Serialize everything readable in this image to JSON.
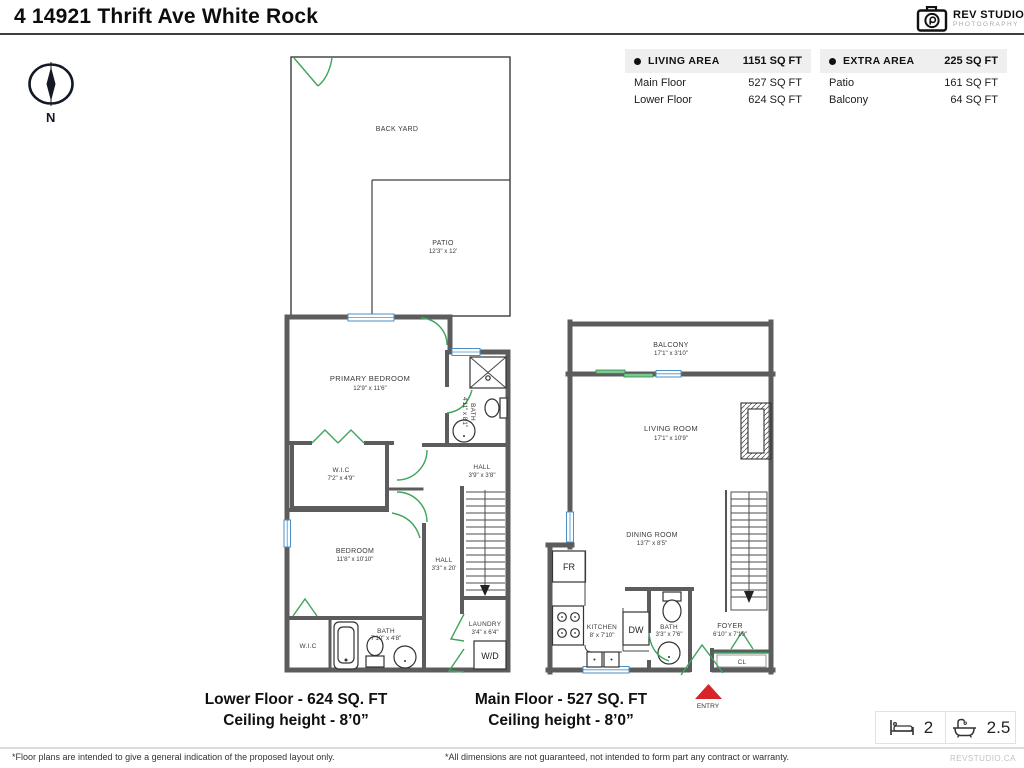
{
  "title": "4 14921 Thrift Ave White Rock",
  "logo": {
    "name": "REV STUDIO",
    "subtitle": "PHOTOGRAPHY"
  },
  "compass": {
    "north_label": "N"
  },
  "tables": {
    "living": {
      "title": "LIVING AREA",
      "total": "1151 SQ FT",
      "rows": [
        {
          "label": "Main Floor",
          "value": "527 SQ FT"
        },
        {
          "label": "Lower Floor",
          "value": "624 SQ FT"
        }
      ]
    },
    "extra": {
      "title": "EXTRA AREA",
      "total": "225 SQ FT",
      "rows": [
        {
          "label": "Patio",
          "value": "161 SQ FT"
        },
        {
          "label": "Balcony",
          "value": "64 SQ FT"
        }
      ]
    }
  },
  "lower": {
    "caption1": "Lower Floor - 624 SQ. FT",
    "caption2": "Ceiling height - 8’0”",
    "rooms": {
      "back_yard": {
        "name": "BACK YARD"
      },
      "patio": {
        "name": "PATIO",
        "dims": "12'3\" x 12'"
      },
      "primary_bedroom": {
        "name": "PRIMARY BEDROOM",
        "dims": "12'9\" x 11'6\""
      },
      "wic_upper": {
        "name": "W.I.C",
        "dims": "7'2\" x 4'9\""
      },
      "bath_upper": {
        "name": "BATH",
        "dims": "4'11\" x 8'1\""
      },
      "hall_upper": {
        "name": "HALL",
        "dims": "3'9\" x 3'8\""
      },
      "bedroom": {
        "name": "BEDROOM",
        "dims": "11'8\" x 10'10\""
      },
      "hall_lower": {
        "name": "HALL",
        "dims": "3'3\" x 20'"
      },
      "wic_lower": {
        "name": "W.I.C"
      },
      "bath_lower": {
        "name": "BATH",
        "dims": "7'10\" x 4'8\""
      },
      "laundry": {
        "name": "LAUNDRY",
        "dims": "3'4\" x 6'4\""
      },
      "wd": {
        "name": "W/D"
      }
    }
  },
  "main": {
    "caption1": "Main Floor - 527 SQ. FT",
    "caption2": "Ceiling height - 8’0”",
    "rooms": {
      "balcony": {
        "name": "BALCONY",
        "dims": "17'1\" x 3'10\""
      },
      "living_room": {
        "name": "LIVING ROOM",
        "dims": "17'1\" x 10'9\""
      },
      "dining_room": {
        "name": "DINING ROOM",
        "dims": "13'7\" x 8'5\""
      },
      "fridge": {
        "name": "FR"
      },
      "kitchen": {
        "name": "KITCHEN",
        "dims": "8' x 7'10\""
      },
      "dishwasher": {
        "name": "DW"
      },
      "bath": {
        "name": "BATH",
        "dims": "3'3\" x 7'6\""
      },
      "foyer": {
        "name": "FOYER",
        "dims": "6'10\" x 7'10\""
      },
      "closet": {
        "name": "CL"
      },
      "entry": {
        "name": "ENTRY"
      }
    }
  },
  "stats": {
    "beds": "2",
    "baths": "2.5"
  },
  "footer": {
    "disclaimer_left": "*Floor plans are intended to give a general indication of the proposed layout only.",
    "disclaimer_center": "*All dimensions are not guaranteed, not intended to form part any contract or warranty.",
    "website": "REVSTUDIO.CA"
  },
  "colors": {
    "wall": "#5c5c5c",
    "door": "#3fa45c",
    "window": "#4a90c8",
    "entry_marker": "#d8232a"
  }
}
